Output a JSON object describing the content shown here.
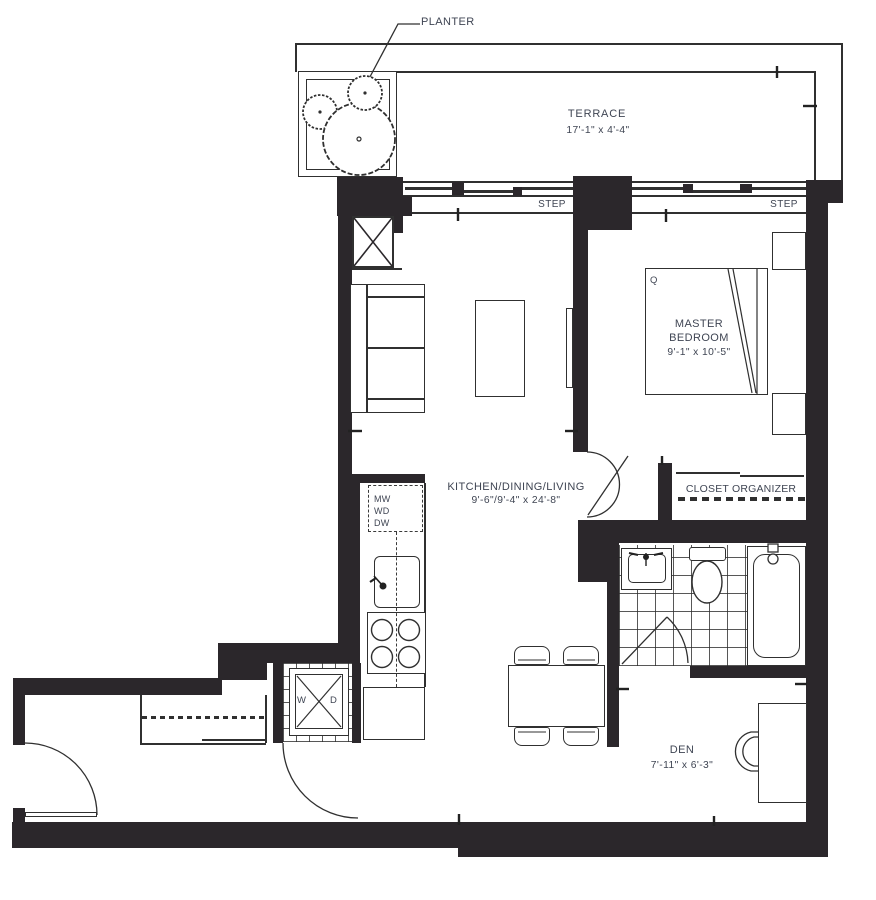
{
  "floorplan": {
    "callouts": {
      "planter": "PLANTER"
    },
    "rooms": {
      "terrace": {
        "name": "TERRACE",
        "dims": "17'-1\" x 4'-4\""
      },
      "master_bedroom": {
        "name_line1": "MASTER",
        "name_line2": "BEDROOM",
        "dims": "9'-1\" x 10'-5\"",
        "bed_code": "Q"
      },
      "kitchen_dining_living": {
        "name": "KITCHEN/DINING/LIVING",
        "dims": "9'-6\"/9'-4\" x 24'-8\""
      },
      "den": {
        "name": "DEN",
        "dims": "7'-11\" x 6'-3\""
      }
    },
    "features": {
      "closet_organizer": "CLOSET ORGANIZER",
      "step_left": "STEP",
      "step_right": "STEP"
    },
    "appliances": {
      "microwave": "MW",
      "washer_dryer_stack": "WD",
      "dishwasher": "DW",
      "washer": "W",
      "dryer": "D"
    },
    "colors": {
      "wall": "#2b272b",
      "line": "#303030",
      "text": "#3f4553"
    }
  }
}
